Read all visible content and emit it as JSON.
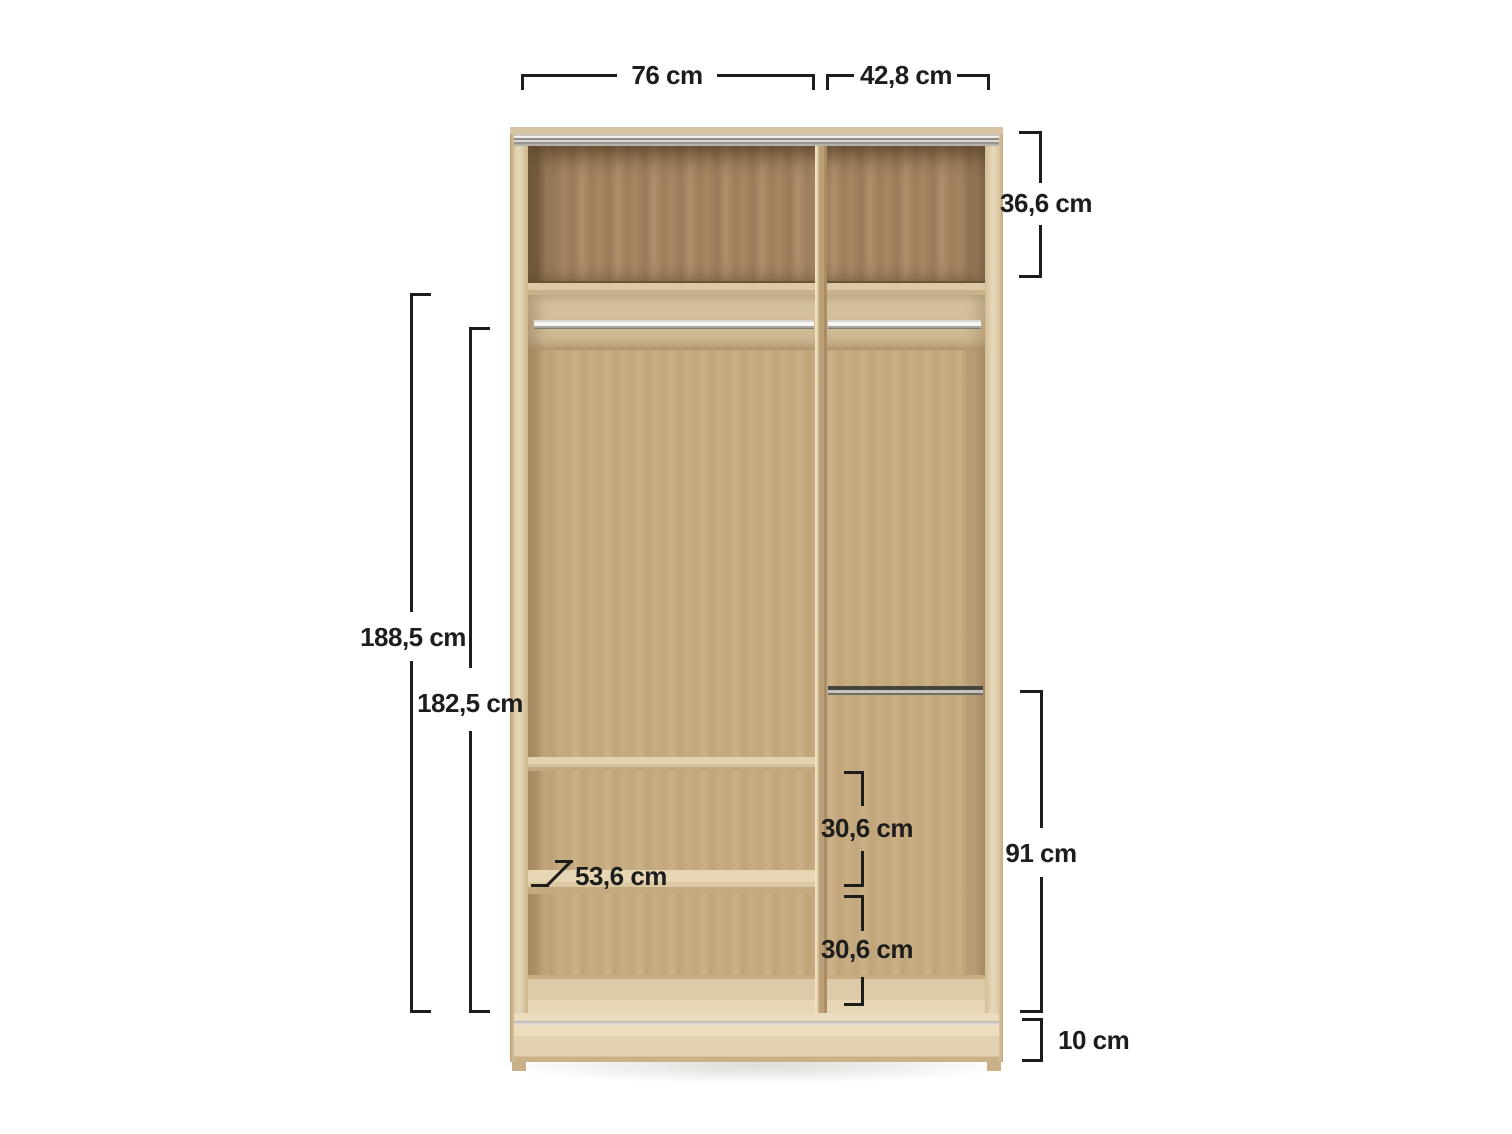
{
  "diagram": {
    "type": "furniture-dimension-diagram",
    "subject": "wardrobe interior with measurements",
    "unit": "cm",
    "line_color": "#1d1d1b",
    "colors": {
      "frame_wood": "#e2d1af",
      "back_panel_wood": "#c4a97f",
      "top_compartment_wood": "#9e8060",
      "shelf_wood": "#ddcaa8",
      "rail_silver": "#c9c8c2",
      "plinth_wood": "#e6d5b3",
      "background": "#ffffff"
    },
    "labels": {
      "width_left": "76 cm",
      "width_right": "42,8 cm",
      "top_section_height": "36,6 cm",
      "height_outer": "188,5 cm",
      "height_inner": "182,5 cm",
      "shelf_depth": "53,6 cm",
      "gap_upper": "30,6 cm",
      "gap_lower": "30,6 cm",
      "right_section_height": "91 cm",
      "plinth_height": "10 cm"
    }
  }
}
